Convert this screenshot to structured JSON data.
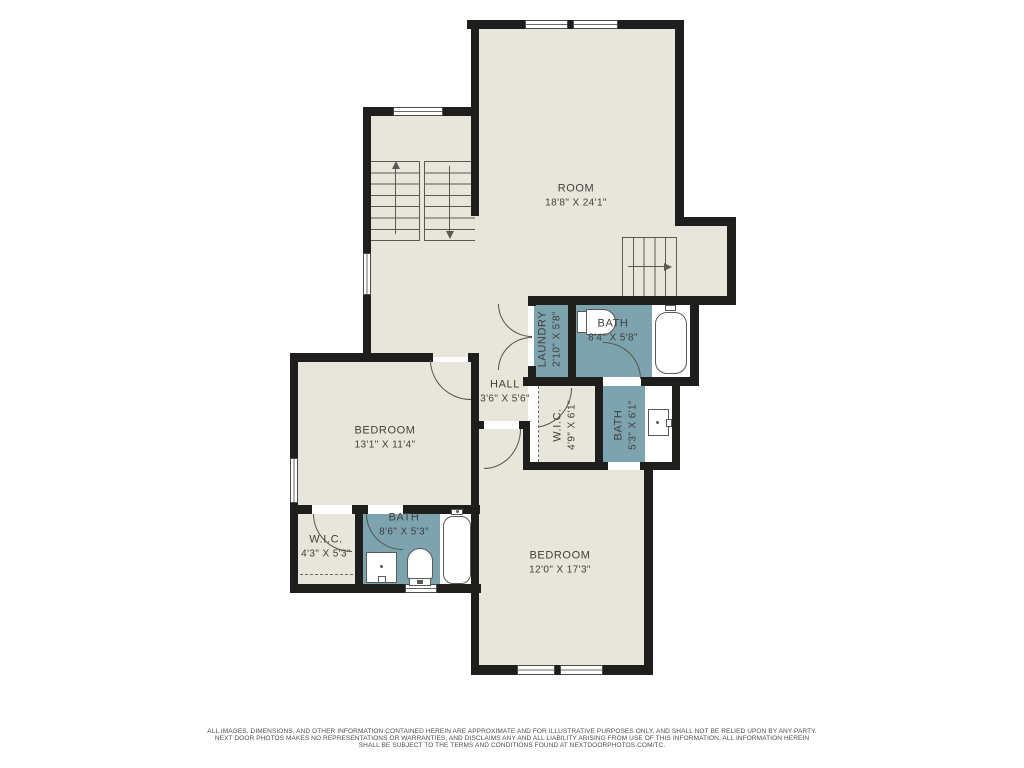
{
  "colors": {
    "wall": "#1e1e1c",
    "floor": "#e8e6da",
    "wet": "#7ca3ae",
    "label": "#3f3f3c"
  },
  "rooms": [
    {
      "id": "room",
      "name": "ROOM",
      "dims": "18'8\" X 24'1\""
    },
    {
      "id": "laundry",
      "name": "LAUNDRY",
      "dims": "2'10\" X 5'8\""
    },
    {
      "id": "bath-upper",
      "name": "BATH",
      "dims": "8'4\" X 5'8\""
    },
    {
      "id": "hall",
      "name": "HALL",
      "dims": "3'6\" X 5'6\""
    },
    {
      "id": "wic-middle",
      "name": "W.I.C.",
      "dims": "4'9\" X 6'1\""
    },
    {
      "id": "bath-middle",
      "name": "BATH",
      "dims": "5'3\" X 6'1\""
    },
    {
      "id": "bedroom-left",
      "name": "BEDROOM",
      "dims": "13'1\" X 11'4\""
    },
    {
      "id": "wic-lower",
      "name": "W.I.C.",
      "dims": "4'3\" X 5'3\""
    },
    {
      "id": "bath-lower",
      "name": "BATH",
      "dims": "8'6\" X 5'3\""
    },
    {
      "id": "bedroom-bottom",
      "name": "BEDROOM",
      "dims": "12'0\" X 17'3\""
    }
  ],
  "footer": {
    "line1": "ALL IMAGES, DIMENSIONS, AND OTHER INFORMATION CONTAINED HEREIN ARE APPROXIMATE AND FOR ILLUSTRATIVE PURPOSES ONLY, AND SHALL NOT BE RELIED UPON BY ANY PARTY.",
    "line2": "NEXT DOOR PHOTOS MAKES NO REPRESENTATIONS OR WARRANTIES, AND DISCLAIMS ANY AND ALL LIABILITY ARISING FROM USE OF THIS INFORMATION. ALL INFORMATION HEREIN",
    "line3": "SHALL BE SUBJECT TO THE TERMS AND CONDITIONS FOUND AT NEXTDOORPHOTOS.COM/TC."
  }
}
